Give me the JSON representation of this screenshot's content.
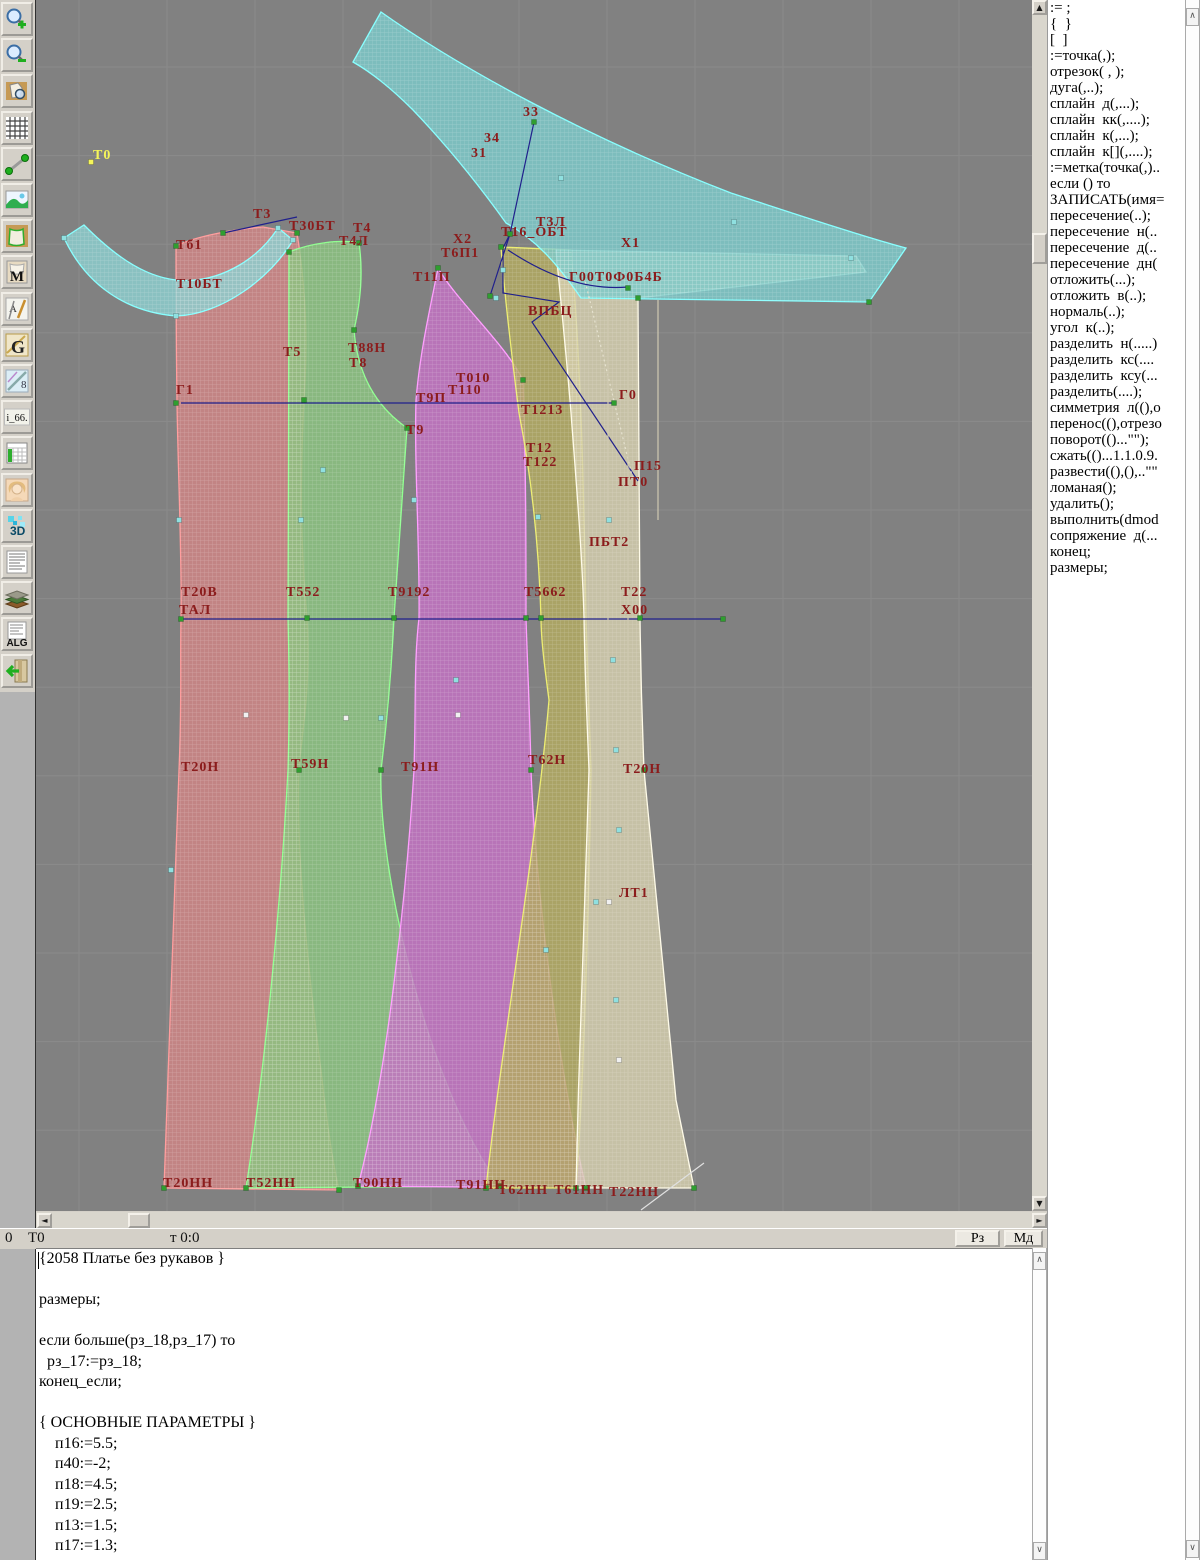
{
  "app_title": "Грация САПР — конструирование одежды",
  "toolbar": {
    "buttons": [
      {
        "icon": "zoom-in-icon"
      },
      {
        "icon": "zoom-out-icon"
      },
      {
        "icon": "preview-icon"
      },
      {
        "icon": "grid-icon"
      },
      {
        "icon": "measure-icon"
      },
      {
        "icon": "image-icon"
      },
      {
        "icon": "pattern-icon"
      },
      {
        "icon": "pattern-m-icon",
        "label": "M"
      },
      {
        "icon": "draw-tools-icon",
        "label": "А"
      },
      {
        "icon": "g-icon",
        "label": "G"
      },
      {
        "icon": "ruler-icon",
        "label": "8"
      },
      {
        "icon": "i66-icon",
        "label": "i_66."
      },
      {
        "icon": "table-icon"
      },
      {
        "icon": "portrait-icon"
      },
      {
        "icon": "3d-icon",
        "label": "3D"
      },
      {
        "icon": "text-doc-icon"
      },
      {
        "icon": "books-icon"
      },
      {
        "icon": "alg-icon",
        "label": "ALG"
      },
      {
        "icon": "exit-icon"
      }
    ]
  },
  "canvas": {
    "background": "#818181",
    "grid_color": "#8b8b8b",
    "label_color": "#8b1c1c",
    "pieces": {
      "red": {
        "fill": "#d18585",
        "stroke": "#ff9d9d"
      },
      "green": {
        "fill": "#8bc480",
        "stroke": "#90ff90"
      },
      "magenta": {
        "fill": "#c471c4",
        "stroke": "#ff9dff"
      },
      "khaki": {
        "fill": "#b3ab60",
        "stroke": "#eded70"
      },
      "beige": {
        "fill": "#d6cfae",
        "stroke": "#fffbe8"
      },
      "collar": {
        "fill": "#8cd0d0",
        "stroke": "#86ffff"
      },
      "band": {
        "fill": "#7ccaca",
        "stroke": "#86ffff"
      }
    },
    "line_colors": {
      "navy": "#20208c",
      "dash": "#e6e2cf",
      "white": "#e0e0e0",
      "seam": "#cfc9b2"
    },
    "marker_colors": {
      "g": "#2f9e2f",
      "c": "#8fe0e0",
      "w": "#f0f0f0",
      "y": "#f5f559"
    },
    "labels": [
      {
        "t": "Т0",
        "x": 57,
        "y": 148,
        "c": "#f5f559"
      },
      {
        "t": "33",
        "x": 487,
        "y": 105
      },
      {
        "t": "34",
        "x": 448,
        "y": 131
      },
      {
        "t": "31",
        "x": 435,
        "y": 146
      },
      {
        "t": "Т3",
        "x": 217,
        "y": 207
      },
      {
        "t": "Т30БТ",
        "x": 253,
        "y": 219
      },
      {
        "t": "Тб1",
        "x": 140,
        "y": 238
      },
      {
        "t": "Т10БТ",
        "x": 140,
        "y": 277
      },
      {
        "t": "Т4",
        "x": 317,
        "y": 221
      },
      {
        "t": "Т4Л",
        "x": 303,
        "y": 234
      },
      {
        "t": "Х2",
        "x": 417,
        "y": 232
      },
      {
        "t": "Т6П1",
        "x": 405,
        "y": 246
      },
      {
        "t": "Т16_ОБТ",
        "x": 465,
        "y": 225
      },
      {
        "t": "Т3Л",
        "x": 500,
        "y": 215
      },
      {
        "t": "Х1",
        "x": 585,
        "y": 236
      },
      {
        "t": "Г00Т0Ф0Б4Б",
        "x": 533,
        "y": 270
      },
      {
        "t": "Т11П",
        "x": 377,
        "y": 270
      },
      {
        "t": "ВПБЦ",
        "x": 492,
        "y": 304
      },
      {
        "t": "Т5",
        "x": 247,
        "y": 345
      },
      {
        "t": "Т88Н",
        "x": 312,
        "y": 341
      },
      {
        "t": "Т8",
        "x": 313,
        "y": 356
      },
      {
        "t": "Т010",
        "x": 420,
        "y": 371
      },
      {
        "t": "Т110",
        "x": 412,
        "y": 383
      },
      {
        "t": "Т9П",
        "x": 380,
        "y": 391
      },
      {
        "t": "Г1",
        "x": 140,
        "y": 383
      },
      {
        "t": "Г0",
        "x": 583,
        "y": 388
      },
      {
        "t": "Т9",
        "x": 370,
        "y": 423
      },
      {
        "t": "Т1213",
        "x": 485,
        "y": 403
      },
      {
        "t": "Т12",
        "x": 490,
        "y": 441
      },
      {
        "t": "Т122",
        "x": 487,
        "y": 455
      },
      {
        "t": "П15",
        "x": 598,
        "y": 459
      },
      {
        "t": "ПТ0",
        "x": 582,
        "y": 475
      },
      {
        "t": "ПБТ2",
        "x": 553,
        "y": 535
      },
      {
        "t": "Т20В",
        "x": 145,
        "y": 585
      },
      {
        "t": "ТАЛ",
        "x": 143,
        "y": 603
      },
      {
        "t": "Т552",
        "x": 250,
        "y": 585
      },
      {
        "t": "Т9192",
        "x": 352,
        "y": 585
      },
      {
        "t": "Т5662",
        "x": 488,
        "y": 585
      },
      {
        "t": "Т22",
        "x": 585,
        "y": 585
      },
      {
        "t": "Х00",
        "x": 585,
        "y": 603
      },
      {
        "t": "Т20Н",
        "x": 145,
        "y": 760
      },
      {
        "t": "Т59Н",
        "x": 255,
        "y": 757
      },
      {
        "t": "Т91Н",
        "x": 365,
        "y": 760
      },
      {
        "t": "Т62Н",
        "x": 492,
        "y": 753
      },
      {
        "t": "Т20Н",
        "x": 587,
        "y": 762
      },
      {
        "t": "ЛТ1",
        "x": 583,
        "y": 886
      },
      {
        "t": "Т20НН",
        "x": 127,
        "y": 1176
      },
      {
        "t": "Т52НН",
        "x": 210,
        "y": 1176
      },
      {
        "t": "Т90НН",
        "x": 317,
        "y": 1176
      },
      {
        "t": "Т91НН",
        "x": 420,
        "y": 1178
      },
      {
        "t": "Т62НН",
        "x": 462,
        "y": 1183
      },
      {
        "t": "Т61НН",
        "x": 518,
        "y": 1183
      },
      {
        "t": "Т22НН",
        "x": 573,
        "y": 1185
      }
    ],
    "markers": [
      [
        140,
        246,
        "g"
      ],
      [
        261,
        233,
        "g"
      ],
      [
        268,
        400,
        "g"
      ],
      [
        271,
        618,
        "g"
      ],
      [
        263,
        770,
        "g"
      ],
      [
        303,
        1190,
        "g"
      ],
      [
        128,
        1188,
        "g"
      ],
      [
        145,
        619,
        "g"
      ],
      [
        140,
        403,
        "g"
      ],
      [
        253,
        252,
        "g"
      ],
      [
        323,
        243,
        "g"
      ],
      [
        318,
        330,
        "g"
      ],
      [
        371,
        428,
        "g"
      ],
      [
        358,
        618,
        "g"
      ],
      [
        345,
        770,
        "g"
      ],
      [
        463,
        1186,
        "g"
      ],
      [
        210,
        1188,
        "g"
      ],
      [
        402,
        268,
        "g"
      ],
      [
        487,
        380,
        "g"
      ],
      [
        490,
        618,
        "g"
      ],
      [
        495,
        770,
        "g"
      ],
      [
        550,
        1188,
        "g"
      ],
      [
        322,
        1186,
        "g"
      ],
      [
        465,
        247,
        "g"
      ],
      [
        505,
        618,
        "g"
      ],
      [
        450,
        1188,
        "g"
      ],
      [
        540,
        1188,
        "g"
      ],
      [
        602,
        298,
        "g"
      ],
      [
        604,
        618,
        "g"
      ],
      [
        608,
        770,
        "g"
      ],
      [
        658,
        1188,
        "g"
      ],
      [
        498,
        122,
        "g"
      ],
      [
        474,
        234,
        "g"
      ],
      [
        454,
        296,
        "g"
      ],
      [
        833,
        302,
        "g"
      ],
      [
        592,
        288,
        "g"
      ],
      [
        187,
        233,
        "g"
      ],
      [
        578,
        403,
        "g"
      ],
      [
        687,
        619,
        "g"
      ],
      [
        143,
        520,
        "c"
      ],
      [
        265,
        520,
        "c"
      ],
      [
        135,
        870,
        "c"
      ],
      [
        287,
        470,
        "c"
      ],
      [
        345,
        718,
        "c"
      ],
      [
        378,
        500,
        "c"
      ],
      [
        420,
        680,
        "c"
      ],
      [
        502,
        517,
        "c"
      ],
      [
        510,
        950,
        "c"
      ],
      [
        573,
        520,
        "c"
      ],
      [
        577,
        660,
        "c"
      ],
      [
        580,
        750,
        "c"
      ],
      [
        583,
        830,
        "c"
      ],
      [
        580,
        1000,
        "c"
      ],
      [
        560,
        902,
        "c"
      ],
      [
        525,
        178,
        "c"
      ],
      [
        698,
        222,
        "c"
      ],
      [
        815,
        258,
        "c"
      ],
      [
        28,
        238,
        "c"
      ],
      [
        140,
        316,
        "c"
      ],
      [
        257,
        240,
        "c"
      ],
      [
        460,
        298,
        "c"
      ],
      [
        242,
        228,
        "c"
      ],
      [
        467,
        270,
        "c"
      ],
      [
        210,
        715,
        "w"
      ],
      [
        310,
        718,
        "w"
      ],
      [
        422,
        715,
        "w"
      ],
      [
        573,
        902,
        "w"
      ],
      [
        583,
        1060,
        "w"
      ],
      [
        55,
        162,
        "y"
      ]
    ],
    "lines": [
      {
        "pts": [
          [
            145,
            403
          ],
          [
            578,
            403
          ]
        ],
        "c": "navy"
      },
      {
        "pts": [
          [
            145,
            619
          ],
          [
            687,
            619
          ]
        ],
        "c": "navy"
      },
      {
        "pts": [
          [
            187,
            233
          ],
          [
            261,
            217
          ]
        ],
        "c": "navy"
      },
      {
        "pts": [
          [
            498,
            122
          ],
          [
            474,
            234
          ],
          [
            454,
            296
          ]
        ],
        "c": "navy"
      },
      {
        "pts": [
          [
            474,
            234
          ],
          [
            467,
            248
          ],
          [
            467,
            293
          ],
          [
            523,
            302
          ],
          [
            496,
            322
          ],
          [
            602,
            481
          ]
        ],
        "c": "navy"
      },
      {
        "d": "M472,250 Q535,292 592,287",
        "c": "navy"
      },
      {
        "pts": [
          [
            547,
            272
          ],
          [
            597,
            480
          ]
        ],
        "c": "dash",
        "dashed": true
      },
      {
        "pts": [
          [
            605,
            1210
          ],
          [
            668,
            1163
          ]
        ],
        "c": "white"
      },
      {
        "pts": [
          [
            572,
            300
          ],
          [
            572,
            1185
          ]
        ],
        "c": "seam"
      },
      {
        "pts": [
          [
            592,
            300
          ],
          [
            592,
            1185
          ]
        ],
        "c": "seam"
      },
      {
        "pts": [
          [
            622,
            300
          ],
          [
            622,
            520
          ]
        ],
        "c": "seam"
      }
    ]
  },
  "scrollbars": {
    "canvas_up": "▲",
    "canvas_down": "▼",
    "canvas_left": "◄",
    "canvas_right": "►",
    "panel_up": "∧",
    "panel_down": "∨"
  },
  "status_bar": {
    "left_value": "0",
    "point_label": "Т0",
    "cursor_readout": "т 0:0",
    "rz_button": "Рз",
    "md_button": "Мд"
  },
  "command_panel": {
    "items": [
      ":= ;",
      "{  }",
      "[  ]",
      ":=точка(,);",
      "отрезок( , );",
      "дуга(,..);",
      "сплайн  д(,...);",
      "сплайн  кк(,....);",
      "сплайн  к(,...);",
      "сплайн  к[](,....);",
      ":=метка(точка(,)..",
      "если () то",
      "ЗАПИСАТЬ(имя=",
      "пересечение(..);",
      "пересечение  н(..",
      "пересечение  д(..",
      "пересечение  дн(",
      "отложить(...);",
      "отложить  в(..);",
      "нормаль(..);",
      "угол  к(..);",
      "разделить  н(.....)",
      "разделить  кс(....",
      "разделить  ксу(...",
      "разделить(....);",
      "симметрия  л((),о",
      "перенос((),отрезо",
      "поворот(()...\"\");",
      "сжать(()...1.1.0.9.",
      "развести((),(),..\"\"",
      "ломаная();",
      "удалить();",
      "выполнить(dmod",
      "сопряжение  д(...",
      "конец;",
      "размеры;"
    ]
  },
  "code_panel": {
    "lines": [
      "{2058 Платье без рукавов }",
      "",
      "размеры;",
      "",
      "если больше(рз_18,рз_17) то",
      "  рз_17:=рз_18;",
      "конец_если;",
      "",
      "{ ОСНОВНЫЕ ПАРАМЕТРЫ }",
      "    п16:=5.5;",
      "    п40:=-2;",
      "    п18:=4.5;",
      "    п19:=2.5;",
      "    п13:=1.5;",
      "    п17:=1.3;"
    ]
  }
}
